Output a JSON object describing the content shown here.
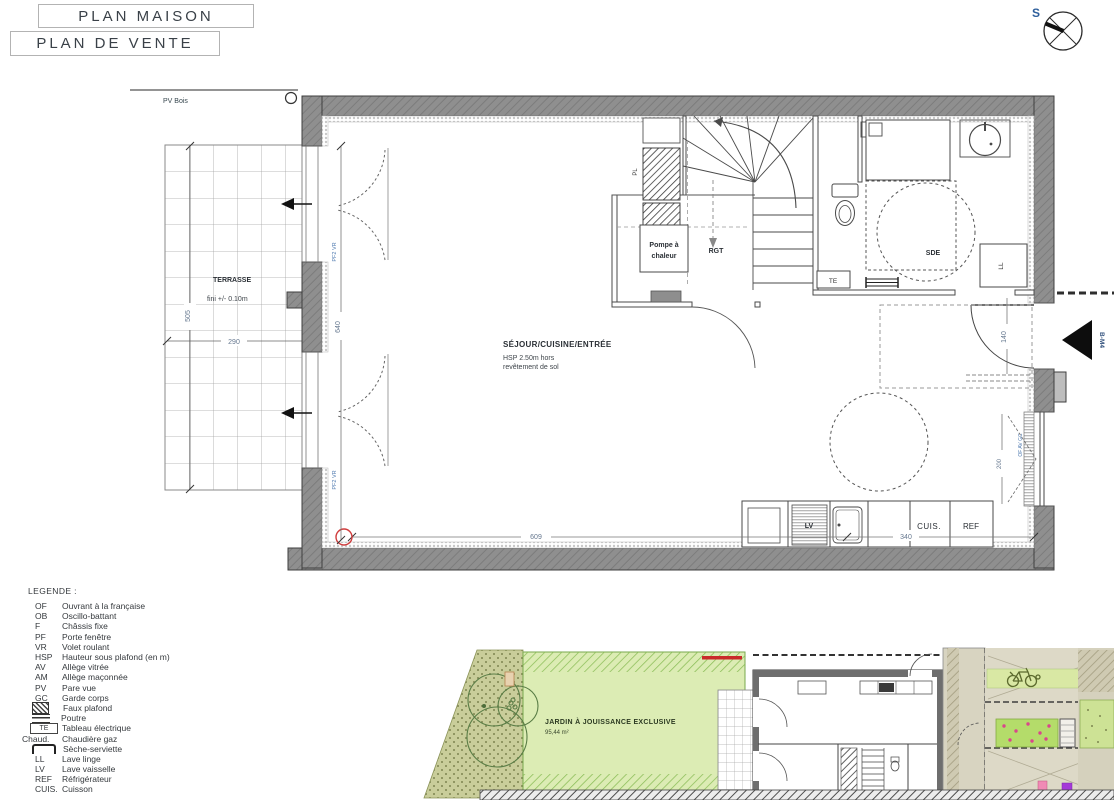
{
  "header": {
    "title_primary": "PLAN MAISON",
    "title_secondary": "PLAN DE VENTE"
  },
  "compass": {
    "south_label": "S"
  },
  "floor_plan": {
    "pv_bois_label": "PV Bois",
    "terrasse_title": "TERRASSE",
    "terrasse_note": "fini +/- 0.10m",
    "sejour_title": "SÉJOUR/CUISINE/ENTRÉE",
    "sejour_note_line1": "HSP 2.50m hors",
    "sejour_note_line2": "revêtement de sol",
    "pompe_line1": "Pompe à",
    "pompe_line2": "chaleur",
    "rgt_label": "RGT",
    "pl_label": "PL",
    "sde_label": "SDE",
    "te_label": "TE",
    "ll_label": "LL",
    "lv_label": "LV",
    "cuis_label": "CUIS.",
    "ref_label": "REF",
    "entry_marker": "B-M4",
    "door_left_tag": "PF2 VR",
    "window_right_tag": "OF AV GC",
    "dims": {
      "terrasse_height": "505",
      "terrasse_width": "290",
      "sejour_height": "640",
      "interior_width": "609",
      "kitchen_run": "340",
      "entry_width": "140",
      "window_width": "200"
    }
  },
  "legend": {
    "title": "LEGENDE :",
    "items": [
      {
        "key": "OF",
        "label": "Ouvrant à la française"
      },
      {
        "key": "OB",
        "label": "Oscillo-battant"
      },
      {
        "key": "F",
        "label": "Châssis fixe"
      },
      {
        "key": "PF",
        "label": "Porte fenêtre"
      },
      {
        "key": "VR",
        "label": "Volet roulant"
      },
      {
        "key": "HSP",
        "label": "Hauteur sous plafond (en m)"
      },
      {
        "key": "AV",
        "label": "Allège vitrée"
      },
      {
        "key": "AM",
        "label": "Allège maçonnée"
      },
      {
        "key": "PV",
        "label": "Pare vue"
      },
      {
        "key": "GC",
        "label": "Garde corps"
      },
      {
        "key": "",
        "icon": "faux-plafond-hatch",
        "label": "Faux plafond"
      },
      {
        "key": "",
        "icon": "poutre-beam",
        "label": "Poutre"
      },
      {
        "key": "TE",
        "icon": "te-box",
        "label": "Tableau électrique"
      },
      {
        "key": "Chaud.",
        "label": "Chaudière gaz"
      },
      {
        "key": "",
        "icon": "seche-serviette",
        "label": "Sèche-serviette"
      },
      {
        "key": "LL",
        "label": "Lave linge"
      },
      {
        "key": "LV",
        "label": "Lave vaisselle"
      },
      {
        "key": "REF",
        "label": "Réfrigérateur"
      },
      {
        "key": "CUIS.",
        "label": "Cuisson"
      }
    ]
  },
  "site_plan": {
    "garden_title": "JARDIN À JOUISSANCE EXCLUSIVE",
    "garden_area": "95,44 m²"
  },
  "colors": {
    "wall_gray": "#8f8f8f",
    "red_marker": "#d03c3c",
    "dim_blue": "#66788f",
    "garden_green": "#dcecb4",
    "garden_hatch_green": "#8bbd58",
    "paving_tan": "#d8d4c1",
    "flower_pink": "#d9468c",
    "accent_purple": "#a438d8",
    "compass_blue": "#2d5e9b",
    "red_line": "#c92a2a"
  }
}
